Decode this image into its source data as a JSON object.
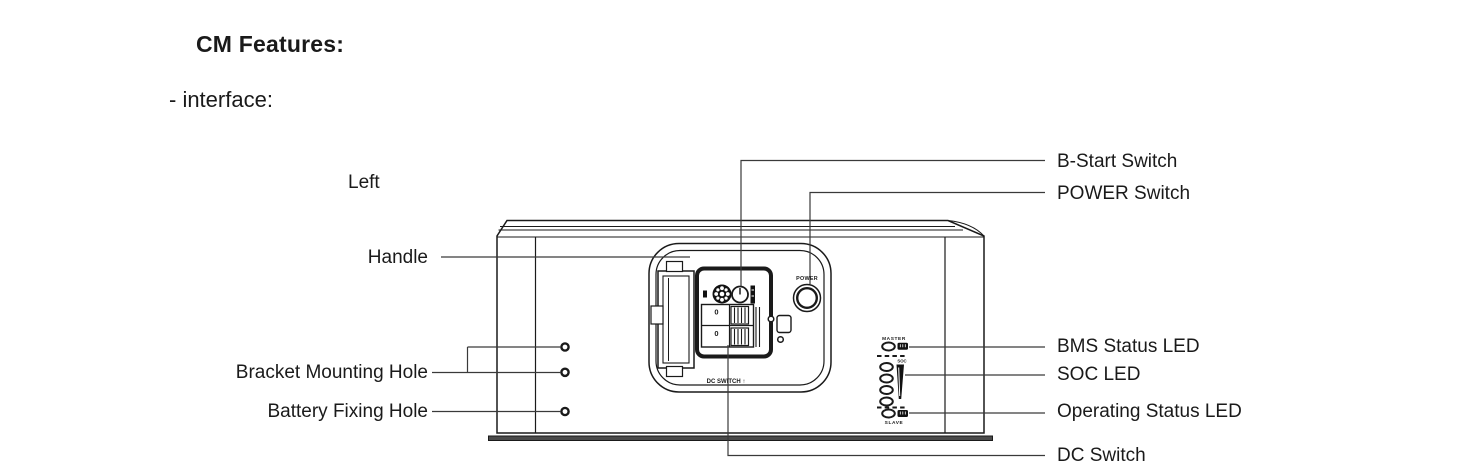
{
  "page": {
    "title": "CM Features:",
    "subtitle": "- interface:"
  },
  "diagram": {
    "view_label": "Left",
    "callouts": {
      "handle": "Handle",
      "bracket_mounting_hole": "Bracket Mounting Hole",
      "battery_fixing_hole": "Battery Fixing Hole",
      "b_start_switch": "B-Start Switch",
      "power_switch": "POWER Switch",
      "bms_status_led": "BMS Status LED",
      "soc_led": "SOC LED",
      "operating_status_led": "Operating Status LED",
      "dc_switch": "DC Switch"
    },
    "device_markings": {
      "power_button": "POWER",
      "dc_switch_label": "DC SWITCH ↑",
      "master": "MASTER",
      "slave": "SLAVE",
      "soc": "SOC",
      "breaker_top": "0",
      "breaker_bottom": "0"
    },
    "colors": {
      "line": "#1a1a1a",
      "leader": "#3a3a3a",
      "background": "#ffffff"
    }
  }
}
